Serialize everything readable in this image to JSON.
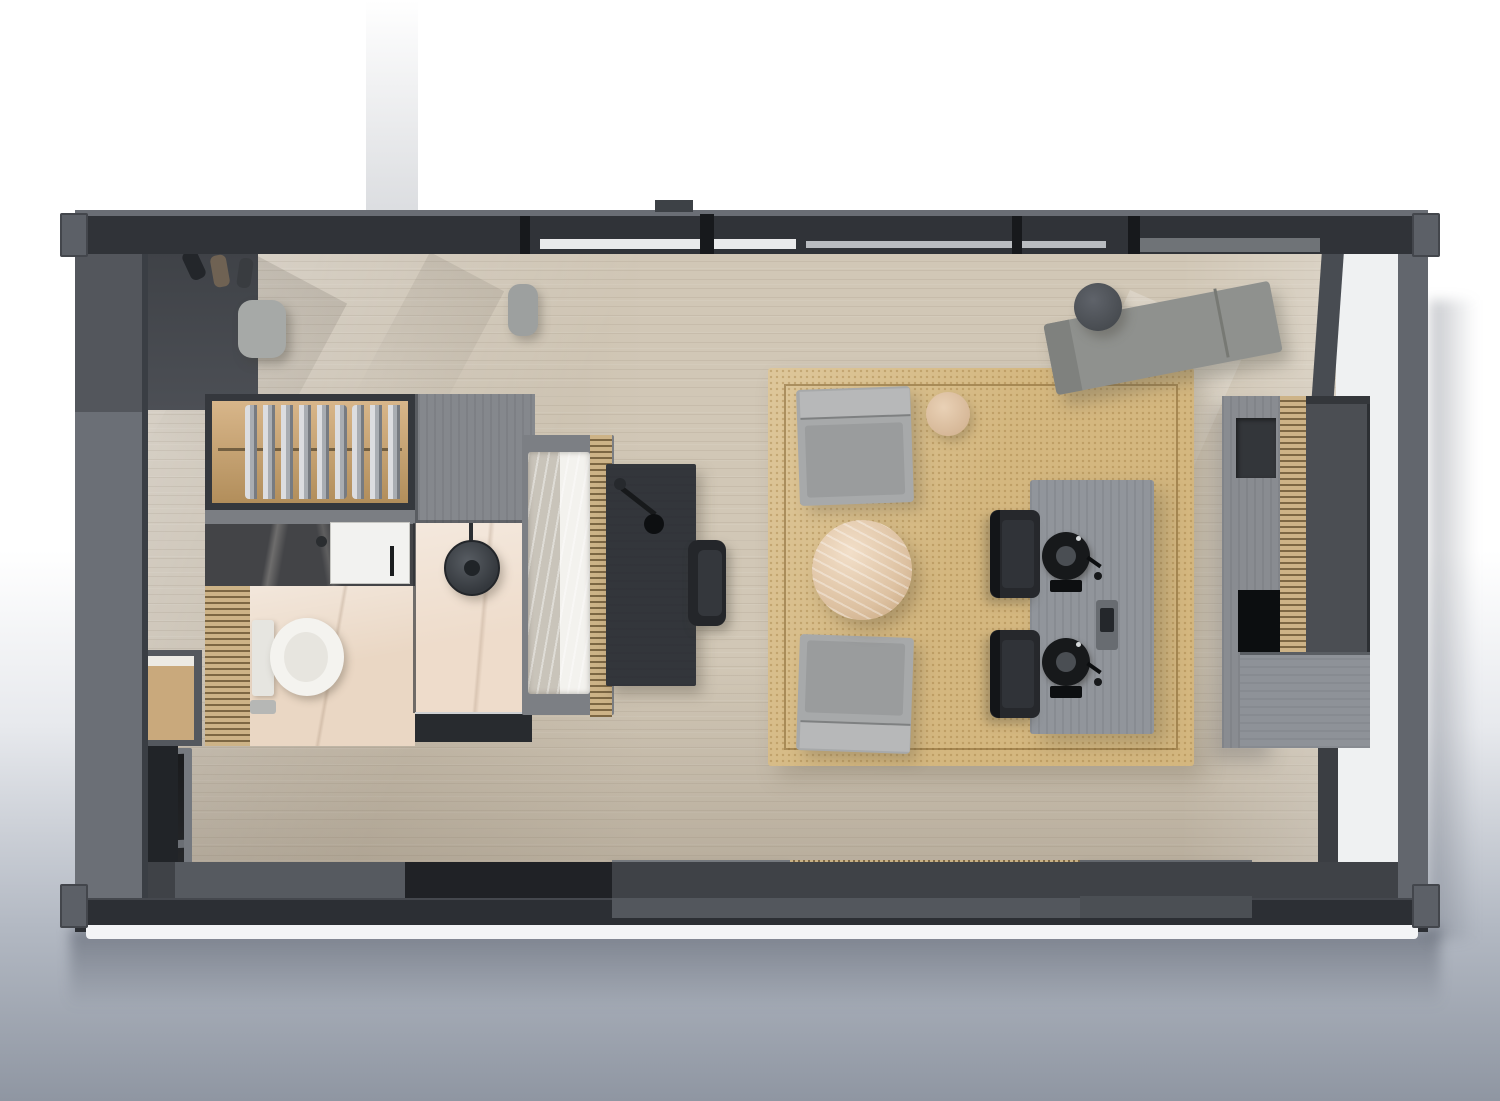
{
  "scene": {
    "type": "floor-plan-render",
    "view": "top-down",
    "title": "Prefab container tiny home - top view 3D floor plan render",
    "background_top": "#ffffff",
    "background_bottom": "#8f96a2"
  },
  "palette": {
    "wall_gray": "#6e727a",
    "wall_dark": "#2e3135",
    "floor_wood": "#d1c7b6",
    "rug_tan": "#d4b77f",
    "marble_pink": "#ead7c4",
    "furniture_gray": "#a7a9aa",
    "furniture_dark": "#26282b",
    "wood_slat": "#cdb387",
    "linen_white": "#f3f2ee"
  },
  "rooms": [
    {
      "name": "Entry"
    },
    {
      "name": "Closet"
    },
    {
      "name": "Bathroom"
    },
    {
      "name": "Shower"
    },
    {
      "name": "Sleeping area"
    },
    {
      "name": "Living room"
    },
    {
      "name": "Dining area"
    },
    {
      "name": "Kitchen"
    },
    {
      "name": "Office nook"
    }
  ],
  "furniture": [
    {
      "name": "entry stool"
    },
    {
      "name": "hanging clothes rail"
    },
    {
      "name": "vanity with sink"
    },
    {
      "name": "toilet"
    },
    {
      "name": "rain shower"
    },
    {
      "name": "double bed"
    },
    {
      "name": "desk with lamp"
    },
    {
      "name": "desk chair"
    },
    {
      "name": "jute area rug"
    },
    {
      "name": "lounge chair"
    },
    {
      "name": "lounge chair"
    },
    {
      "name": "round marble coffee table"
    },
    {
      "name": "round side table"
    },
    {
      "name": "dining table"
    },
    {
      "name": "dining chair"
    },
    {
      "name": "dining chair"
    },
    {
      "name": "place setting"
    },
    {
      "name": "place setting"
    },
    {
      "name": "serving tray"
    },
    {
      "name": "work bench / chaise"
    },
    {
      "name": "round stool"
    },
    {
      "name": "kitchen unit with counter"
    },
    {
      "name": "wall TV / fireplace"
    },
    {
      "name": "storage bench"
    },
    {
      "name": "wall niche cabinet"
    },
    {
      "name": "window seat pad"
    }
  ]
}
